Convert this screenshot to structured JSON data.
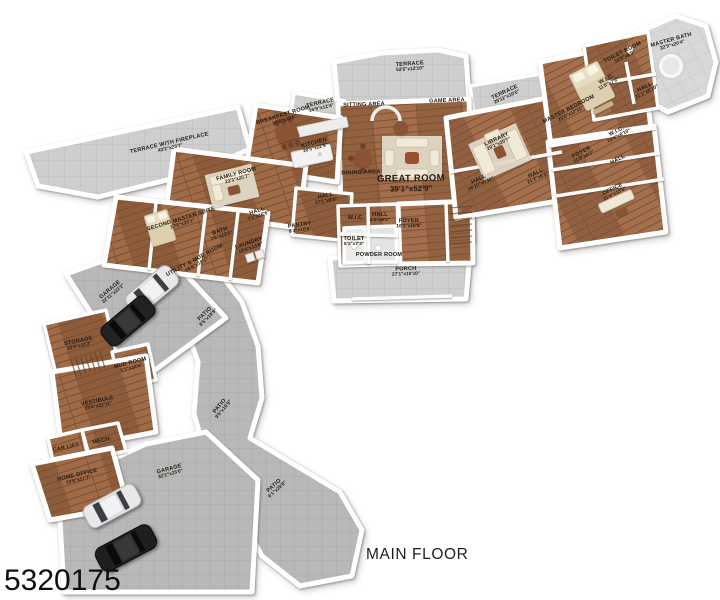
{
  "footer": {
    "floor_label": "MAIN FLOOR",
    "listing_id": "5320175"
  },
  "palette": {
    "wood": "#9a6847",
    "wood_dark": "#7d5136",
    "terrace_gray": "#cdcdcd",
    "garage_gray": "#b7b7b7",
    "wall_white": "#ffffff",
    "label_text": "#241c12",
    "furniture_cream": "#f1ead8",
    "table_brown": "#8a5434",
    "car_white": "#e8e8e8",
    "car_black": "#222222"
  },
  "rooms": {
    "terrace_top": {
      "name": "TERRACE",
      "dims": "52'6\"x12'10\""
    },
    "sitting_area": {
      "name": "SITTING AREA"
    },
    "game_area": {
      "name": "GAME AREA"
    },
    "great_room": {
      "name": "GREAT ROOM",
      "dims": "39'1\"x52'9\""
    },
    "dining_area": {
      "name": "DINING AREA"
    },
    "foyer": {
      "name": "FOYER",
      "dims": "16'1\"x19'8\""
    },
    "porch": {
      "name": "PORCH",
      "dims": "27'1\"x10'10\""
    },
    "wic_center": {
      "name": "W.I.C."
    },
    "hall_foyer": {
      "name": "HALL",
      "dims": "4'1\"x9'2\""
    },
    "toilet": {
      "name": "TOILET",
      "dims": "5'1\"x7'3\""
    },
    "powder_room": {
      "name": "POWDER ROOM"
    },
    "terrace_right": {
      "name": "TERRACE",
      "dims": "20'11\"x10'6\""
    },
    "library": {
      "name": "LIBRARY",
      "dims": "20'1\"x20'7\""
    },
    "hall_right": {
      "name": "HALL",
      "dims": "21'2\"x6'1\""
    },
    "hall_mid": {
      "name": "HALL",
      "dims": "16'10\"x5'11\""
    },
    "master_bedroom": {
      "name": "MASTER BEDROOM",
      "dims": "21'6\"x17'11\""
    },
    "master_bath": {
      "name": "MASTER BATH",
      "dims": "22'9\"x20'4\""
    },
    "toilet_room": {
      "name": "TOILET ROOM",
      "dims": "10'9\"x6'9\""
    },
    "wic_1": {
      "name": "W.I.C.",
      "dims": "11'6\"x7'6\""
    },
    "hall_master": {
      "name": "HALL",
      "dims": "11'1\"x6'10\""
    },
    "wic_2": {
      "name": "W.I.C.",
      "dims": "13'4\"x6'10\""
    },
    "foyer_right": {
      "name": "FOYER",
      "dims": "11'9\"x6'2\""
    },
    "hall_small_right": {
      "name": "HALL"
    },
    "office": {
      "name": "OFFICE",
      "dims": "15'6\"x15'6\""
    },
    "kitchen": {
      "name": "KITCHEN",
      "dims": "20'5\"x22'8\""
    },
    "breakfast_room": {
      "name": "BREAKFAST ROOM",
      "dims": "14'6\"x11'5\""
    },
    "terrace_small": {
      "name": "TERRACE",
      "dims": "16'9\"x12'4\""
    },
    "terrace_fireplace": {
      "name": "TERRACE WITH FIREPLACE",
      "dims": "43'2\"x23'7\""
    },
    "family_room": {
      "name": "FAMILY ROOM",
      "dims": "23'3\"x25'7\""
    },
    "hall_center": {
      "name": "HALL",
      "dims": "17'1\"x8'6\""
    },
    "pantry": {
      "name": "PANTRY",
      "dims": "8'4\"x10'6\""
    },
    "second_master": {
      "name": "SECOND MASTER SUITE",
      "dims": "17'0\"x23'1\""
    },
    "hall_sm": {
      "name": "HALL",
      "dims": "7'1\"x16'6\""
    },
    "bath_sm": {
      "name": "BATH",
      "dims": "7'6\"x13'6\""
    },
    "laundry": {
      "name": "LAUNDRY",
      "dims": "10'4\"x13'6\""
    },
    "utility_mud": {
      "name": "UTILITY & MUD ROOM",
      "dims": "15'6\"x18'1\""
    },
    "garage_upper": {
      "name": "GARAGE",
      "dims": "32'11\"x23'2\""
    },
    "patio_upper": {
      "name": "PATIO",
      "dims": "8'5\"x19'9\""
    },
    "storage": {
      "name": "STORAGE",
      "dims": "13'4\"x11'2\""
    },
    "mud_room": {
      "name": "MUD ROOM",
      "dims": "5'1\"x10'5\""
    },
    "vestibule": {
      "name": "VESTIBULE",
      "dims": "23'4\"x21'11\""
    },
    "patio_mid": {
      "name": "PATIO",
      "dims": "9'5\"x10'9\""
    },
    "car_lift": {
      "name": "CAR LIFT"
    },
    "mech_room": {
      "name": "MECH."
    },
    "home_office": {
      "name": "HOME OFFICE",
      "dims": "13'8\"x17'7\""
    },
    "garage_lower": {
      "name": "GARAGE",
      "dims": "32'2\"x23'0\""
    },
    "patio_lower": {
      "name": "PATIO",
      "dims": "6'1\"x29'8\""
    }
  }
}
